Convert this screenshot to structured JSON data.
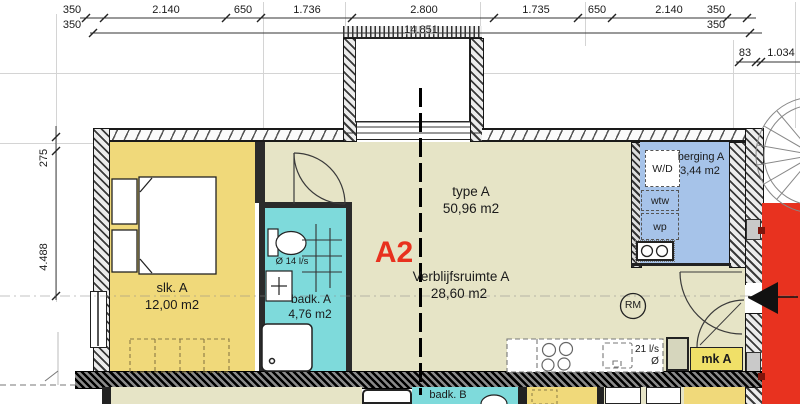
{
  "colors": {
    "bedroom": "#f0d97a",
    "living": "#e6e4c6",
    "bathroom": "#7edadb",
    "storage": "#a6c3e9",
    "red": "#e8321f",
    "accent_text": "#e8311e"
  },
  "dims": {
    "top_row1": [
      "350",
      "2.140",
      "650",
      "1.736",
      "2.800",
      "1.735",
      "650",
      "2.140",
      "350"
    ],
    "top_row2": [
      "350",
      "14.851",
      "350"
    ],
    "right": [
      "83",
      "1.034"
    ],
    "left": [
      "275",
      "4.488"
    ]
  },
  "rooms": {
    "bedroom": {
      "name": "slk. A",
      "area": "12,00 m2"
    },
    "bathroom_a": {
      "name": "badk. A",
      "area": "4,76 m2",
      "vent": "Ø 14 l/s"
    },
    "living": {
      "type_name": "type A",
      "type_area": "50,96 m2",
      "name": "Verblijfsruimte A",
      "area": "28,60 m2"
    },
    "unit_label": "A2",
    "storage": {
      "name": "berging A",
      "area": "3,44 m2",
      "washer_dryer": "W/D",
      "heat_recovery": "wtw",
      "heat_pump": "wp"
    },
    "kitchen": {
      "vent": "21 l/s",
      "vent_symbol": "Ø"
    },
    "meter_closet": {
      "label": "mk A"
    },
    "smoke_detector": {
      "label": "RM"
    },
    "bathroom_b": {
      "name": "badk. B"
    }
  }
}
